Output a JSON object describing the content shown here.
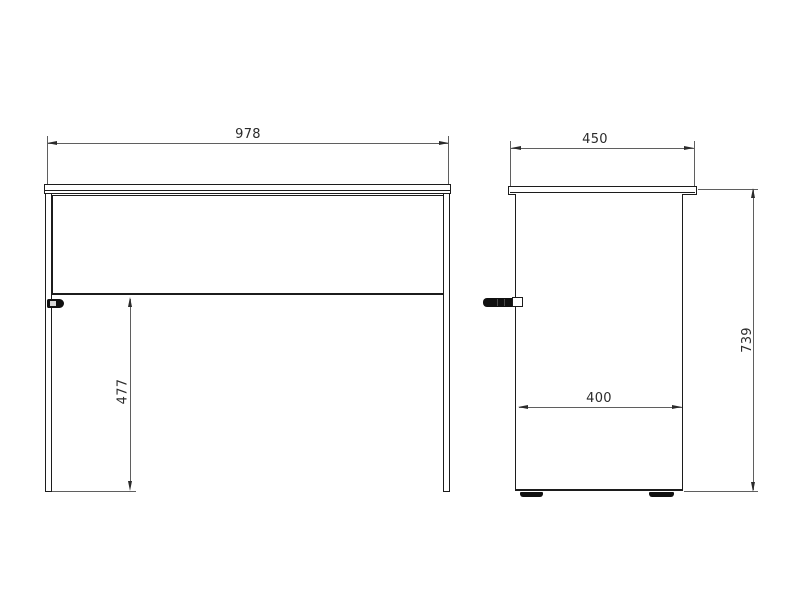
{
  "drawing": {
    "background_color": "#ffffff",
    "object_line_color": "#1c1c1c",
    "dimension_line_color": "#5f5f5f",
    "text_color": "#2b2b2b",
    "front_view": {
      "dimensions": {
        "overall_width": "978",
        "under_rail_clearance": "477"
      }
    },
    "side_view": {
      "dimensions": {
        "top_depth": "450",
        "panel_depth": "400",
        "overall_height": "739"
      }
    }
  }
}
